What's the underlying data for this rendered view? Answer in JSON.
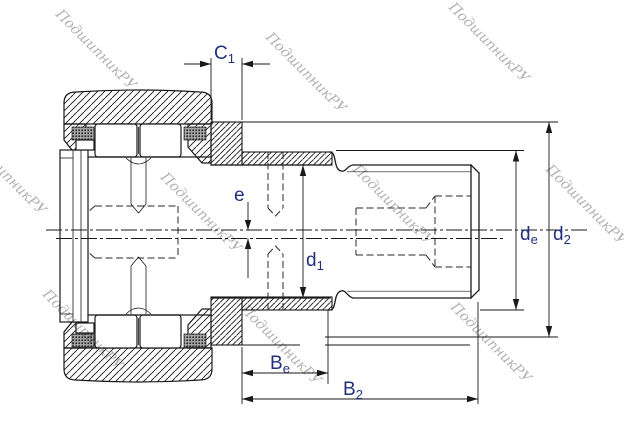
{
  "watermark": {
    "text": "ПодшипникРУ"
  },
  "dims": {
    "c1": {
      "main": "C",
      "sub": "1"
    },
    "e": {
      "main": "e",
      "sub": ""
    },
    "d1": {
      "main": "d",
      "sub": "1"
    },
    "de": {
      "main": "d",
      "sub": "e"
    },
    "d2": {
      "main": "d",
      "sub": "2"
    },
    "be": {
      "main": "B",
      "sub": "e"
    },
    "b2": {
      "main": "B",
      "sub": "2"
    }
  },
  "colors": {
    "line": "#1a1a1a",
    "label": "#22307f",
    "watermark": "#b1b1b1",
    "background": "#ffffff"
  }
}
